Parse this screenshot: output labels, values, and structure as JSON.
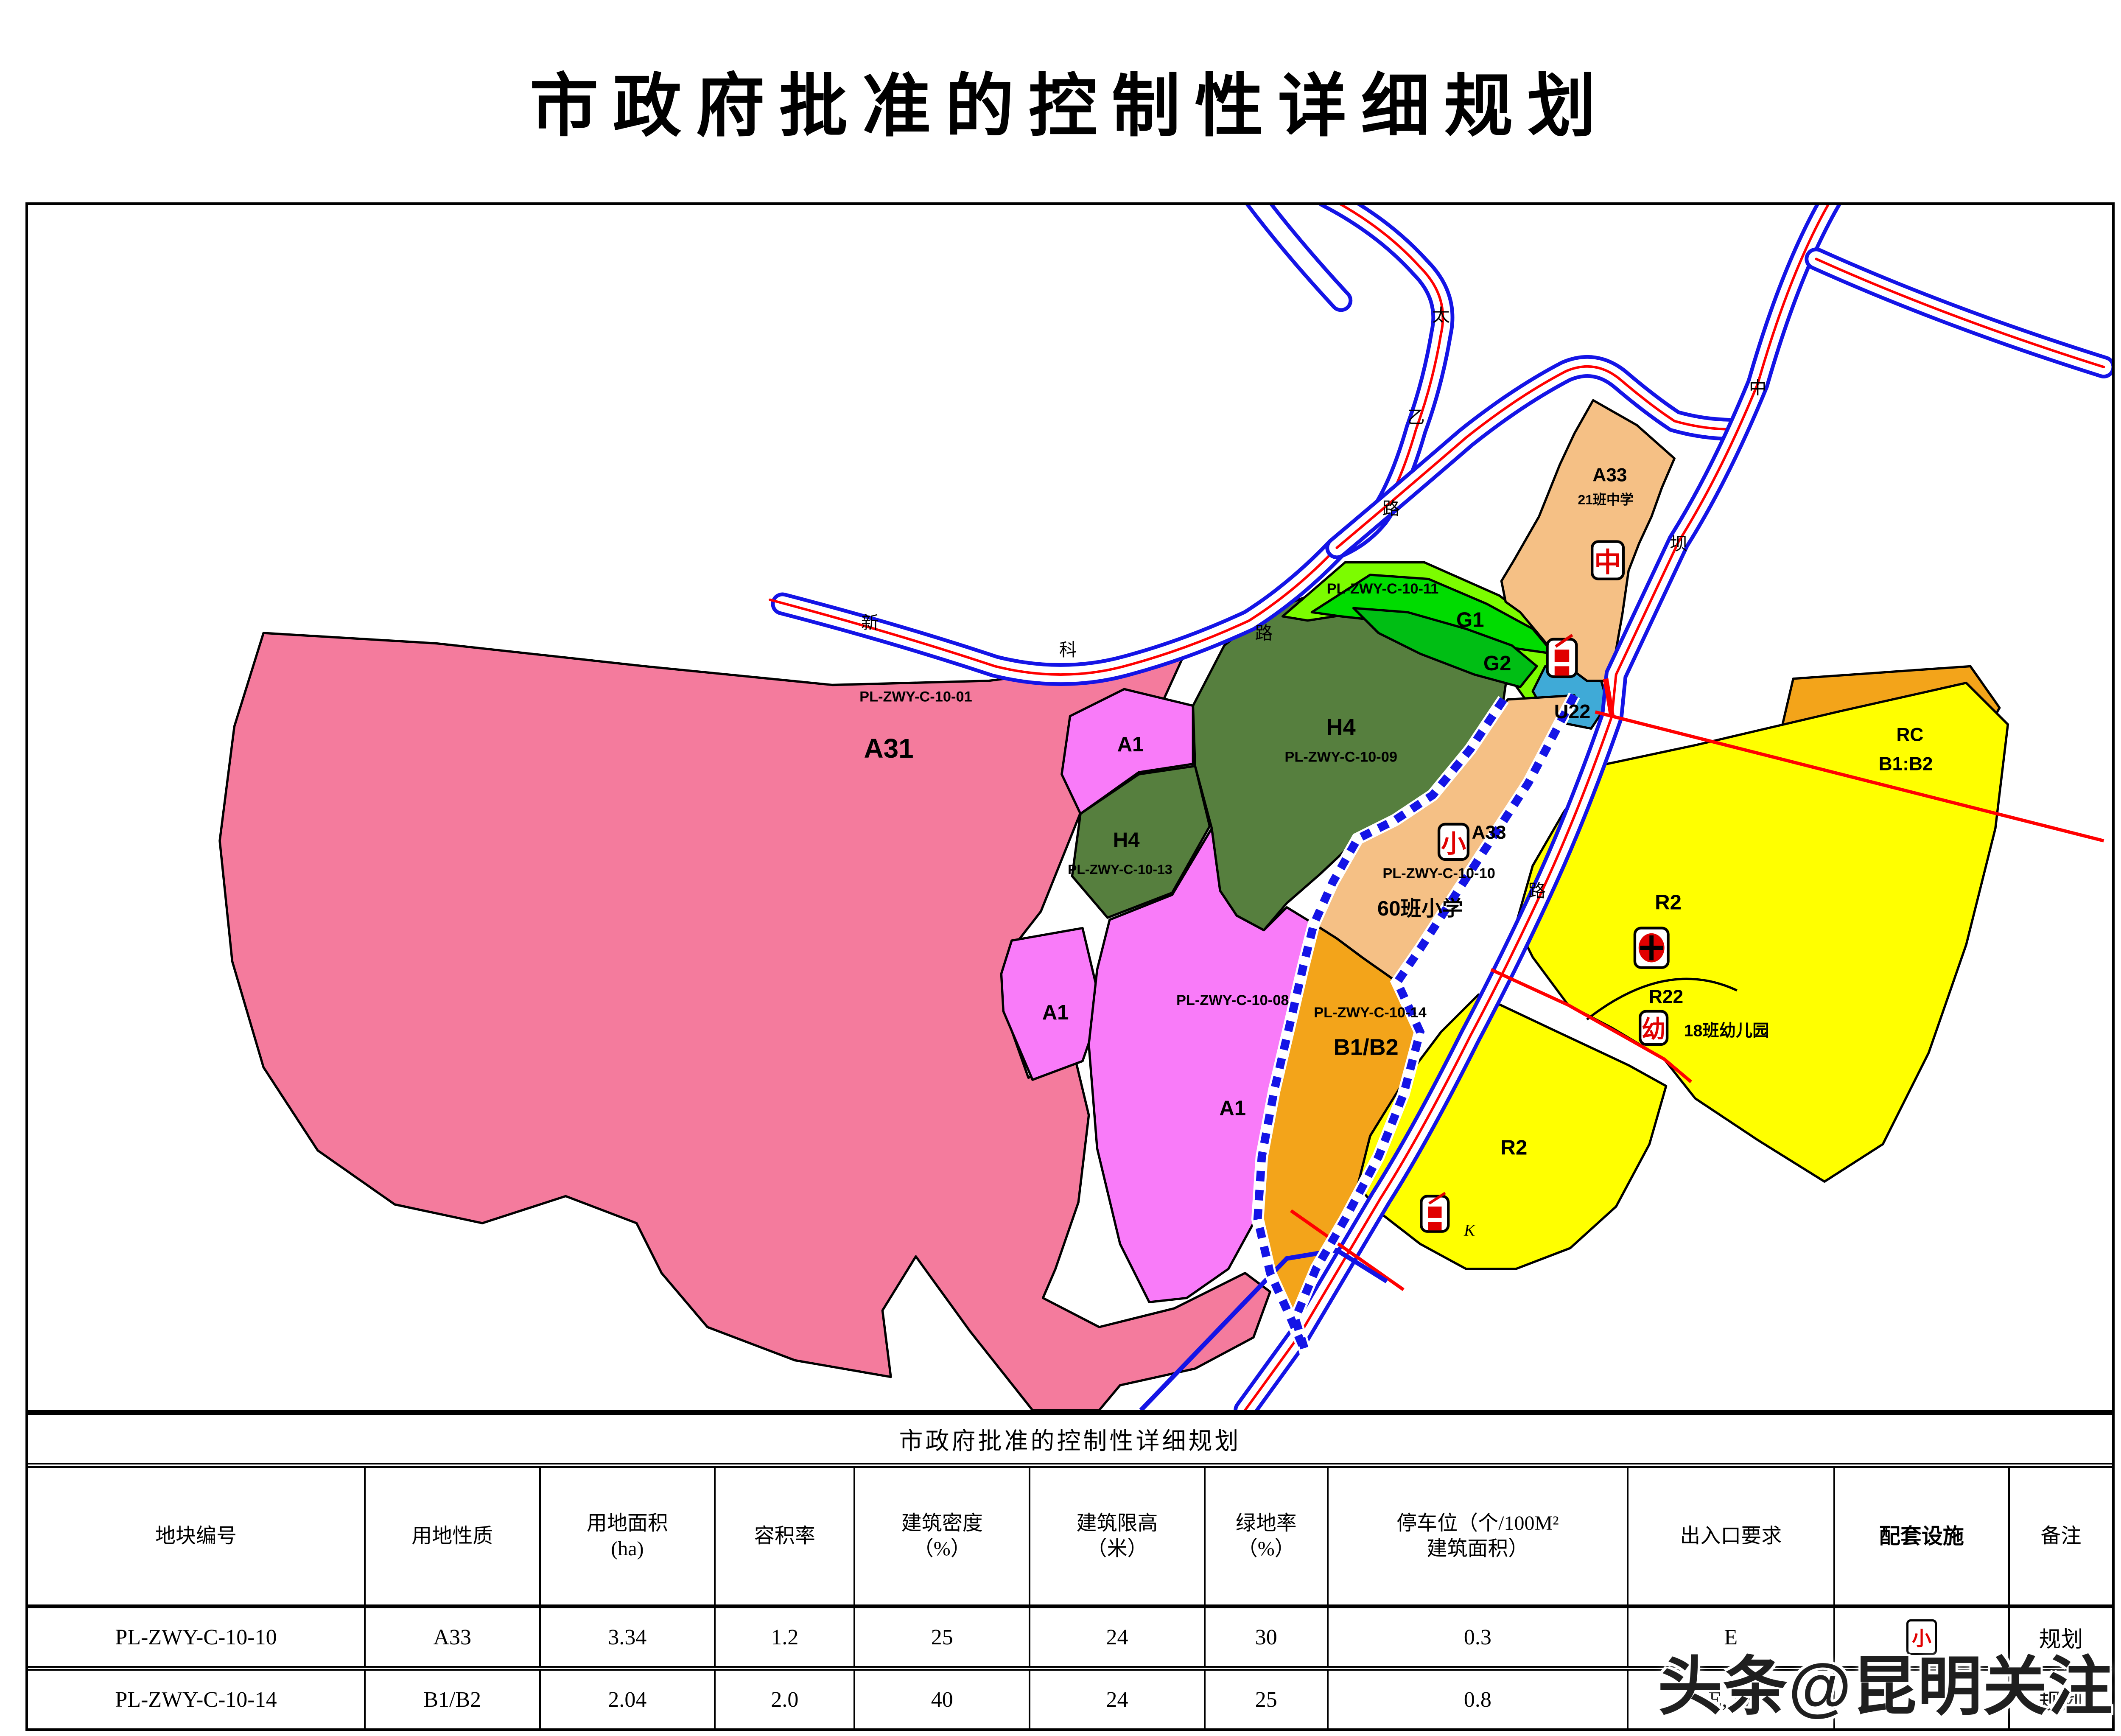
{
  "page_title": "市政府批准的控制性详细规划",
  "watermark": "头条@昆明关注",
  "map": {
    "colors": {
      "a31_pink": "#F47B9D",
      "a1_magenta": "#F97BF9",
      "h4_green": "#567F3E",
      "g_light_green": "#7CFC00",
      "g1_green": "#00DC00",
      "g2_green": "#00BE14",
      "u22_blue": "#3FAAD7",
      "a33_peach": "#F5C085",
      "b_orange": "#F3A41A",
      "r2_yellow": "#FFFF00",
      "road_blue": "#1414E6",
      "road_red": "#FF0000"
    },
    "parcels": {
      "a31": {
        "code": "PL-ZWY-C-10-01",
        "zone": "A31"
      },
      "a1_upper": {
        "zone": "A1"
      },
      "a1_left": {
        "zone": "A1"
      },
      "a1_big": {
        "code": "PL-ZWY-C-10-08",
        "zone": "A1"
      },
      "h4_big": {
        "zone": "H4",
        "code": "PL-ZWY-C-10-09"
      },
      "h4_small": {
        "zone": "H4",
        "code": "PL-ZWY-C-10-13"
      },
      "g1": {
        "code": "PL-ZWY-C-10-11",
        "zone": "G1"
      },
      "g2": {
        "zone": "G2"
      },
      "u22": {
        "zone": "U22"
      },
      "a33_middle_school": {
        "zone": "A33",
        "name": "21班中学",
        "icon": "中"
      },
      "a33_primary_school": {
        "zone": "A33",
        "code": "PL-ZWY-C-10-10",
        "name": "60班小学",
        "icon": "小"
      },
      "rc": {
        "zone": "RC",
        "sub": "B1:B2"
      },
      "b1b2": {
        "code": "PL-ZWY-C-10-14",
        "zone": "B1/B2"
      },
      "r2_upper": {
        "zone": "R2"
      },
      "r22": {
        "zone": "R22",
        "name": "18班幼儿园",
        "icon": "幼"
      },
      "r2_lower": {
        "zone": "R2",
        "mark": "K"
      }
    },
    "roads": {
      "taiyi": {
        "name": "太乙路",
        "chars": [
          "太",
          "乙",
          "路"
        ]
      },
      "xinke": {
        "name": "新科路",
        "chars": [
          "新",
          "科",
          "路"
        ]
      },
      "zhongba": {
        "name": "中坝路",
        "chars": [
          "中",
          "坝",
          "路"
        ]
      }
    }
  },
  "table": {
    "title": "市政府批准的控制性详细规划",
    "headers": [
      "地块编号",
      "用地性质",
      "用地面积\n(ha)",
      "容积率",
      "建筑密度\n（%）",
      "建筑限高\n（米）",
      "绿地率\n（%）",
      "停车位（个/100M²\n建筑面积）",
      "出入口要求",
      "配套设施",
      "备注"
    ],
    "rows": [
      {
        "plot": "PL-ZWY-C-10-10",
        "use": "A33",
        "area": "3.34",
        "far": "1.2",
        "density": "25",
        "height": "24",
        "green": "30",
        "parking": "0.3",
        "access": "E",
        "facilities_icon": "小",
        "note": "规划"
      },
      {
        "plot": "PL-ZWY-C-10-14",
        "use": "B1/B2",
        "area": "2.04",
        "far": "2.0",
        "density": "40",
        "height": "24",
        "green": "25",
        "parking": "0.8",
        "access": "E, W",
        "facilities_icon": "",
        "note": "规划"
      }
    ]
  }
}
